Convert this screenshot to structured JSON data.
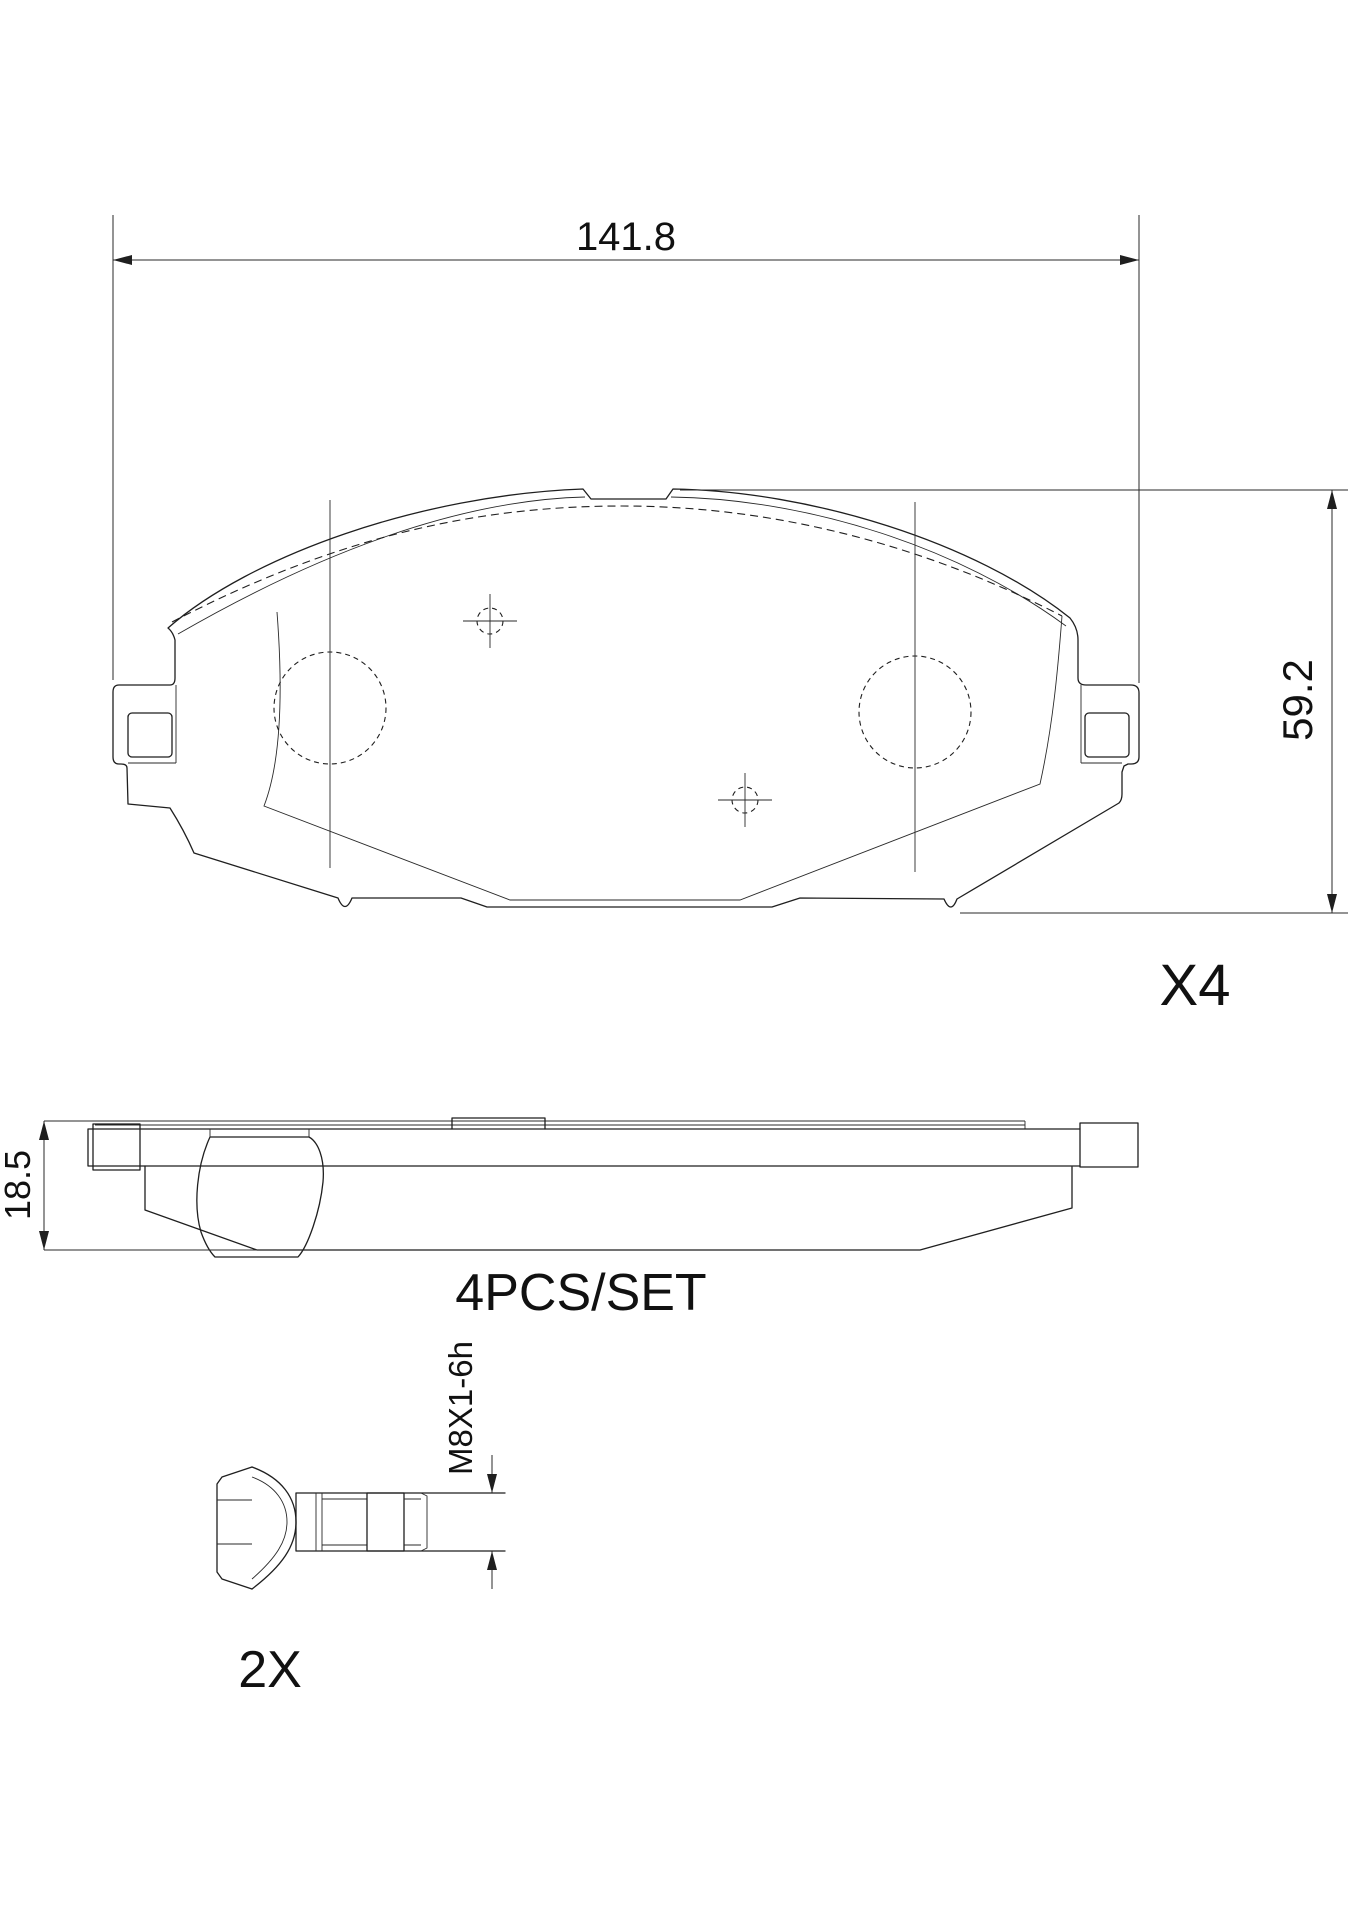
{
  "drawing": {
    "dimensions": {
      "pad_width": "141.8",
      "pad_height": "59.2",
      "pad_thickness": "18.5",
      "bolt_thread": "M8X1-6h"
    },
    "labels": {
      "pad_quantity": "X4",
      "set_quantity": "4PCS/SET",
      "bolt_quantity": "2X"
    },
    "colors": {
      "background": "#ffffff",
      "line": "#1f1f1f"
    }
  }
}
